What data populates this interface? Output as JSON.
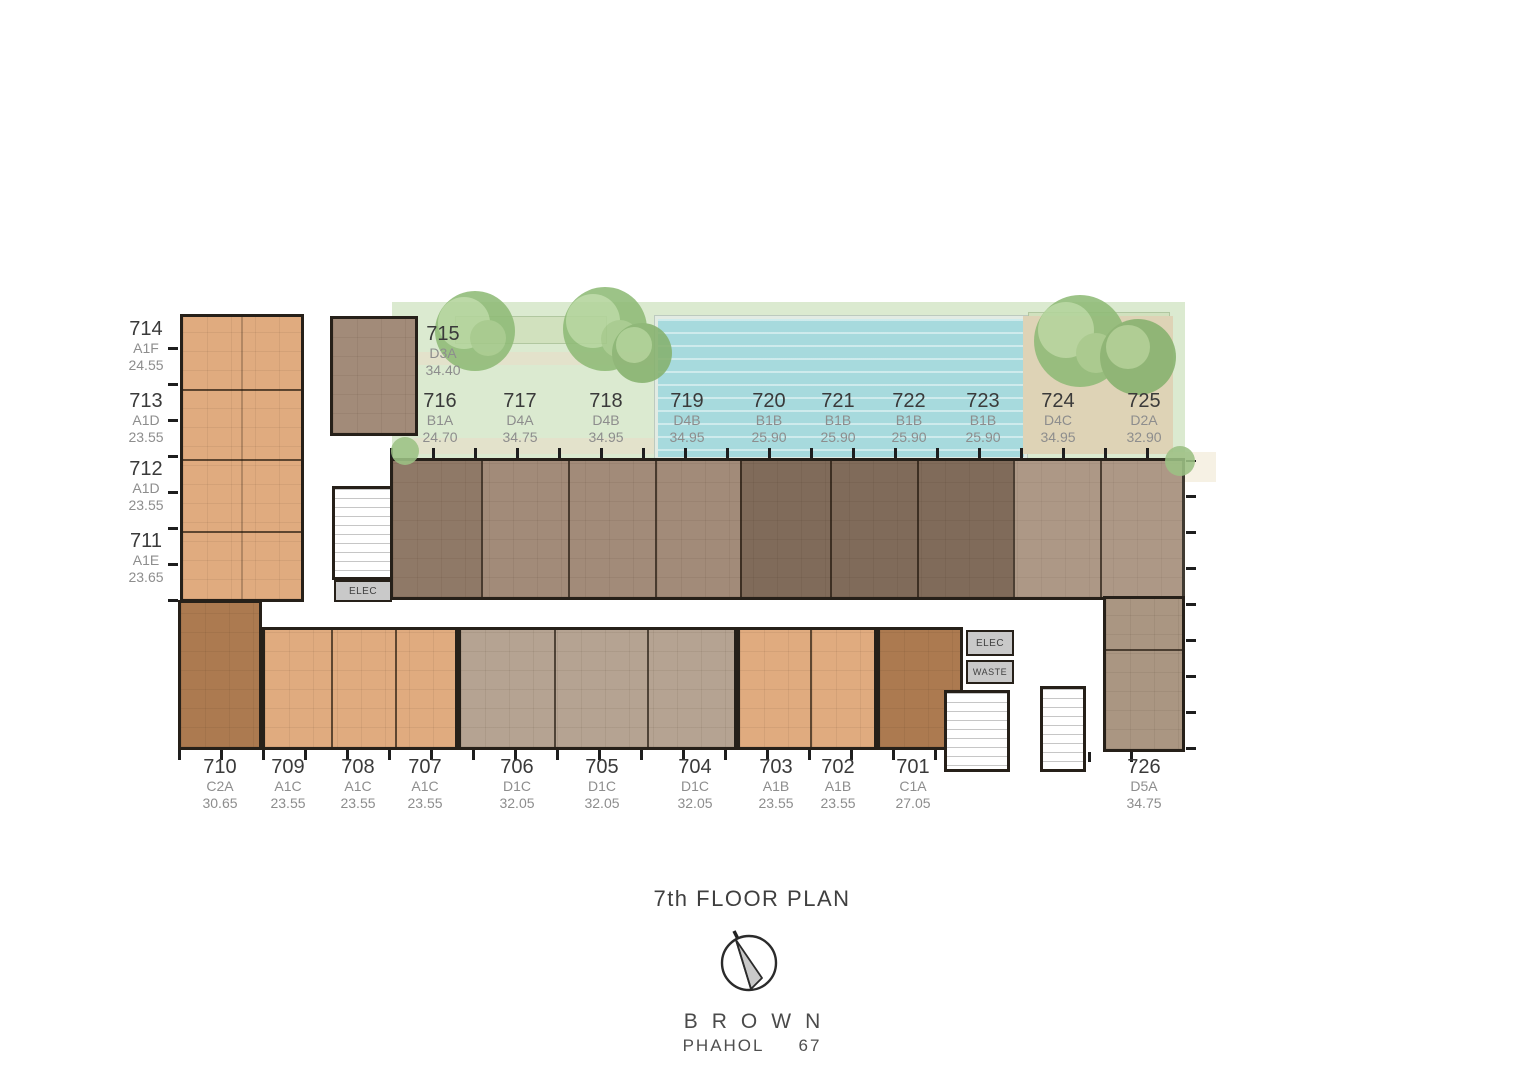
{
  "title": "7th FLOOR PLAN",
  "footer": {
    "brand": "BROWN",
    "location_name": "PHAHOL",
    "location_no": "67"
  },
  "plan": {
    "elec_label": "ELEC",
    "waste_label": "WASTE"
  },
  "units": [
    {
      "no": "714",
      "type": "A1F",
      "area": "24.55"
    },
    {
      "no": "713",
      "type": "A1D",
      "area": "23.55"
    },
    {
      "no": "712",
      "type": "A1D",
      "area": "23.55"
    },
    {
      "no": "711",
      "type": "A1E",
      "area": "23.65"
    },
    {
      "no": "715",
      "type": "D3A",
      "area": "34.40"
    },
    {
      "no": "716",
      "type": "B1A",
      "area": "24.70"
    },
    {
      "no": "717",
      "type": "D4A",
      "area": "34.75"
    },
    {
      "no": "718",
      "type": "D4B",
      "area": "34.95"
    },
    {
      "no": "719",
      "type": "D4B",
      "area": "34.95"
    },
    {
      "no": "720",
      "type": "B1B",
      "area": "25.90"
    },
    {
      "no": "721",
      "type": "B1B",
      "area": "25.90"
    },
    {
      "no": "722",
      "type": "B1B",
      "area": "25.90"
    },
    {
      "no": "723",
      "type": "B1B",
      "area": "25.90"
    },
    {
      "no": "724",
      "type": "D4C",
      "area": "34.95"
    },
    {
      "no": "725",
      "type": "D2A",
      "area": "32.90"
    },
    {
      "no": "710",
      "type": "C2A",
      "area": "30.65"
    },
    {
      "no": "709",
      "type": "A1C",
      "area": "23.55"
    },
    {
      "no": "708",
      "type": "A1C",
      "area": "23.55"
    },
    {
      "no": "707",
      "type": "A1C",
      "area": "23.55"
    },
    {
      "no": "706",
      "type": "D1C",
      "area": "32.05"
    },
    {
      "no": "705",
      "type": "D1C",
      "area": "32.05"
    },
    {
      "no": "704",
      "type": "D1C",
      "area": "32.05"
    },
    {
      "no": "703",
      "type": "A1B",
      "area": "23.55"
    },
    {
      "no": "702",
      "type": "A1B",
      "area": "23.55"
    },
    {
      "no": "701",
      "type": "C1A",
      "area": "27.05"
    },
    {
      "no": "726",
      "type": "D5A",
      "area": "34.75"
    }
  ],
  "colors": {
    "wall": "#262019",
    "lawn": "#dbead0",
    "planter": "#cfe0ba",
    "path": "#e6dfca",
    "pool": "#a7dadd",
    "deck": "#ded3b6",
    "service": "#c9c9c9",
    "unit_orange_light": "#e0ab7f",
    "unit_orange_dark": "#ac7a50",
    "unit_taupe": "#b5a392",
    "unit_brown_mid": "#a28b79",
    "unit_brown_dark": "#836e5c",
    "unit_brown_light": "#aa9682"
  }
}
